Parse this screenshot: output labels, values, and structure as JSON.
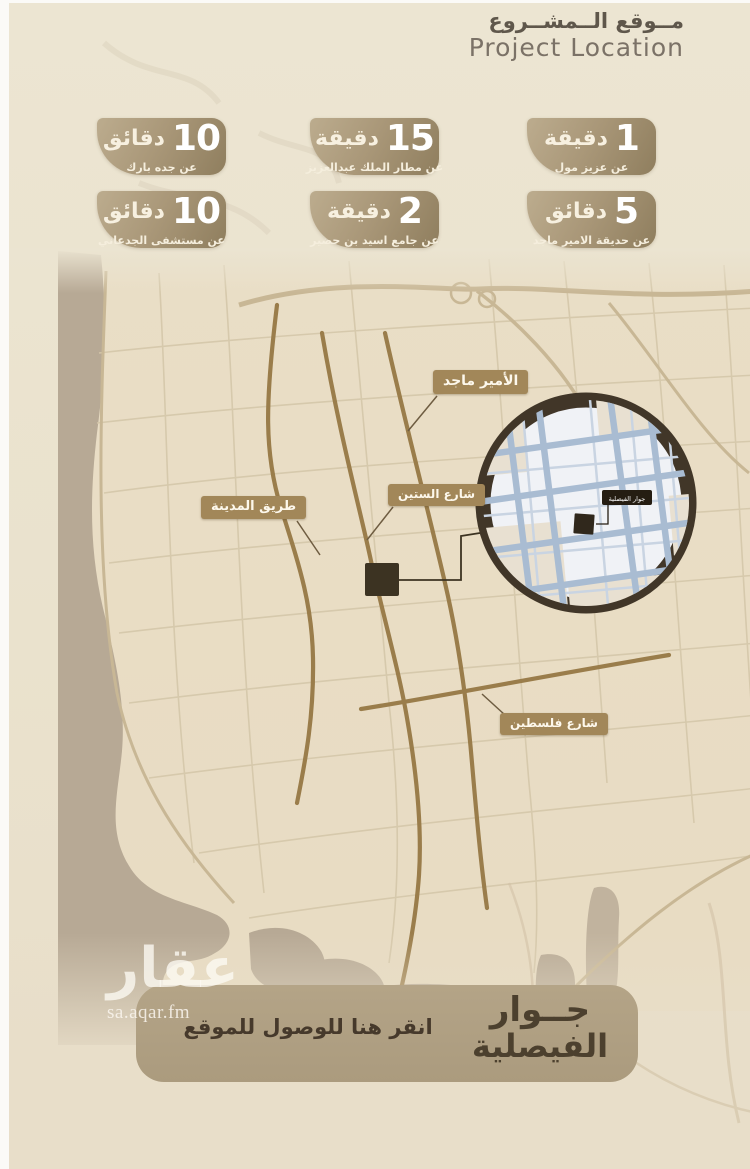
{
  "header": {
    "title_ar": "مــوقع الــمشــروع",
    "title_en": "Project Location"
  },
  "badges": [
    {
      "value": "1",
      "unit": "دقيقة",
      "subtitle": "عن عزيز مول"
    },
    {
      "value": "15",
      "unit": "دقيقة",
      "subtitle": "عن مطار الملك عبدالعزيز"
    },
    {
      "value": "10",
      "unit": "دقائق",
      "subtitle": "عن جده بارك"
    },
    {
      "value": "5",
      "unit": "دقائق",
      "subtitle": "عن حديقة الامير ماجد"
    },
    {
      "value": "2",
      "unit": "دقيقة",
      "subtitle": "عن جامع اسيد بن حضير"
    },
    {
      "value": "10",
      "unit": "دقائق",
      "subtitle": "عن مستشفى الجدعاني"
    }
  ],
  "map": {
    "road_labels": [
      {
        "label": "الأمير ماجد"
      },
      {
        "label": "شارع الستين"
      },
      {
        "label": "طريق المدينة"
      },
      {
        "label": "شارع فلسطين"
      }
    ],
    "inset_label": "جوار الفيصلية"
  },
  "footer": {
    "project_name_line1": "جــوار",
    "project_name_line2": "الفيصلية",
    "cta": "انقر هنا للوصول للموقع",
    "watermark_ar": "عقار",
    "watermark_url": "sa.aqar.fm"
  },
  "colors": {
    "background": "#eae2cd",
    "badge_gradient_start": "#bcac8e",
    "badge_gradient_end": "#8f7e5e",
    "main_road_gold": "#9a7d4b",
    "road_label_bg": "#a28759",
    "sea": "#b7a995",
    "inset_ring": "#413628",
    "inset_street": "#a9bcd2",
    "marker": "#3c3322",
    "cta_panel_bg": "#b0a083",
    "title_text": "#5f574b"
  }
}
